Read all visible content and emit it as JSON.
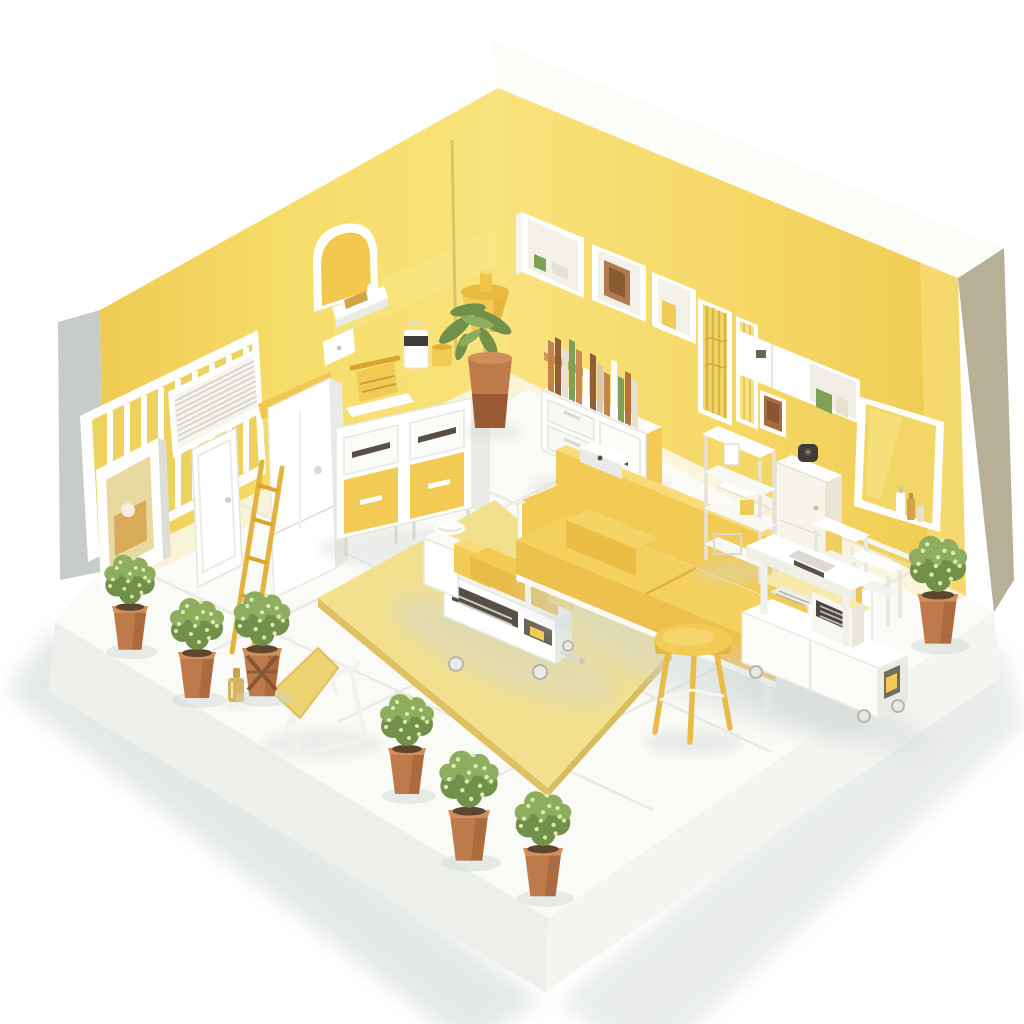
{
  "meta": {
    "title": "Isometric miniature room with yellow walls and white floor, furnished as a small clinic lounge",
    "style": "3D isometric cutaway diorama, two walls, white platform base",
    "background": "#FFFFFF"
  },
  "palette": {
    "wallYellow": "#F6DC69",
    "wallYellowDeep": "#EFCB52",
    "wallHighlight": "#FAE98F",
    "furnYellow": "#F2CB55",
    "furnYellowDeep": "#E8BC49",
    "furnYellowDark": "#D9A52F",
    "furnYellowLight": "#F7DC79",
    "rugYellow": "#F3E08F",
    "rugEdge": "#DFC162",
    "white": "#FFFFFF",
    "whiteSoft": "#F4F5F1",
    "whiteShade": "#EAEBE5",
    "whiteShade2": "#DDDFD7",
    "outerGray": "#C8CCC8",
    "wallSideTan": "#B7B096",
    "floorWhite": "#FAFAF6",
    "tileLine": "#E8E8E1",
    "shadow": "#CFD7D5",
    "terracotta": "#BF7A4B",
    "terracottaDark": "#9A5A34",
    "terracottaLight": "#D18D5C",
    "soil": "#5D4530",
    "plantGreen": "#8FAD5F",
    "plantGreenDark": "#71904A",
    "plantGreenLight": "#DDEAAE",
    "bookOrange": "#C2834C",
    "bookBrown": "#925E36",
    "bookGreen": "#7FA057",
    "bookCream": "#E7E1D1",
    "gold": "#D3A24A",
    "deviceDark": "#45423D",
    "slotDark": "#564F45",
    "metal": "#C9C9C3"
  },
  "scene": {
    "room": {
      "left_wall": "yellow",
      "right_wall": "yellow",
      "floor": "white tiles on thick white platform",
      "plant_count": 8
    },
    "objects": [
      {
        "id": "slatted-window",
        "label": "white framed window with vertical slats, left wall"
      },
      {
        "id": "louver-vent",
        "label": "white louvered vent panel, left wall"
      },
      {
        "id": "display-case",
        "label": "white shadow-box display case with gold items"
      },
      {
        "id": "white-door",
        "label": "white door leaning on left wall"
      },
      {
        "id": "yellow-ladder",
        "label": "yellow step ladder"
      },
      {
        "id": "wardrobe",
        "label": "tall white wardrobe cabinet with yellow side panel"
      },
      {
        "id": "arch-mirror",
        "label": "arched wall mirror with yellow face and white shelf"
      },
      {
        "id": "wall-switch",
        "label": "small white wall plate"
      },
      {
        "id": "dresser",
        "label": "dresser with white top drawers and yellow lower drawers"
      },
      {
        "id": "typewriter",
        "label": "yellow vintage machine on tray atop dresser"
      },
      {
        "id": "coffee-jar",
        "label": "white jar with dark band and yellow cup on dresser"
      },
      {
        "id": "cone-lamp",
        "label": "yellow cone floor lamp in corner"
      },
      {
        "id": "palm-plant",
        "label": "palm plant in two-tier terracotta pot"
      },
      {
        "id": "wall-cabinet-row",
        "label": "three white wall cabinets with books and framed picture"
      },
      {
        "id": "long-wall-cabinet",
        "label": "long white wall cabinet with open book end"
      },
      {
        "id": "small-picture",
        "label": "small brown framed picture"
      },
      {
        "id": "slat-frames",
        "label": "two tall slatted frames on right wall"
      },
      {
        "id": "book-sideboard",
        "label": "white sideboard with row of upright books"
      },
      {
        "id": "wall-mirror",
        "label": "large framed mirror with perfume bottles on ledge"
      },
      {
        "id": "chair-rail",
        "label": "white trim rail on right wall"
      },
      {
        "id": "open-shelving",
        "label": "white open shelving unit"
      },
      {
        "id": "camera-cabinet",
        "label": "tall cream cabinet with small black camera on top"
      },
      {
        "id": "side-tables",
        "label": "two small white side tables"
      },
      {
        "id": "medical-cart",
        "label": "white rolling cart with register device and keyboard"
      },
      {
        "id": "sofa",
        "label": "yellow two-seat sofa with bolster cushion and white tray"
      },
      {
        "id": "daybed",
        "label": "hospital-style daybed cart with raised yellow mattress and storage trays"
      },
      {
        "id": "stool",
        "label": "round yellow three-leg stool"
      },
      {
        "id": "rug",
        "label": "yellow area rug"
      },
      {
        "id": "lounge-chair",
        "label": "white lounge chair with yellow wedge cushion"
      },
      {
        "id": "perfume-bottle",
        "label": "small gold bottle on floor"
      },
      {
        "id": "potted-plants",
        "label": "small round bushes in terracotta pots along floor edges"
      },
      {
        "id": "wall-rod",
        "label": "thin rod on left wall near corner"
      }
    ]
  }
}
